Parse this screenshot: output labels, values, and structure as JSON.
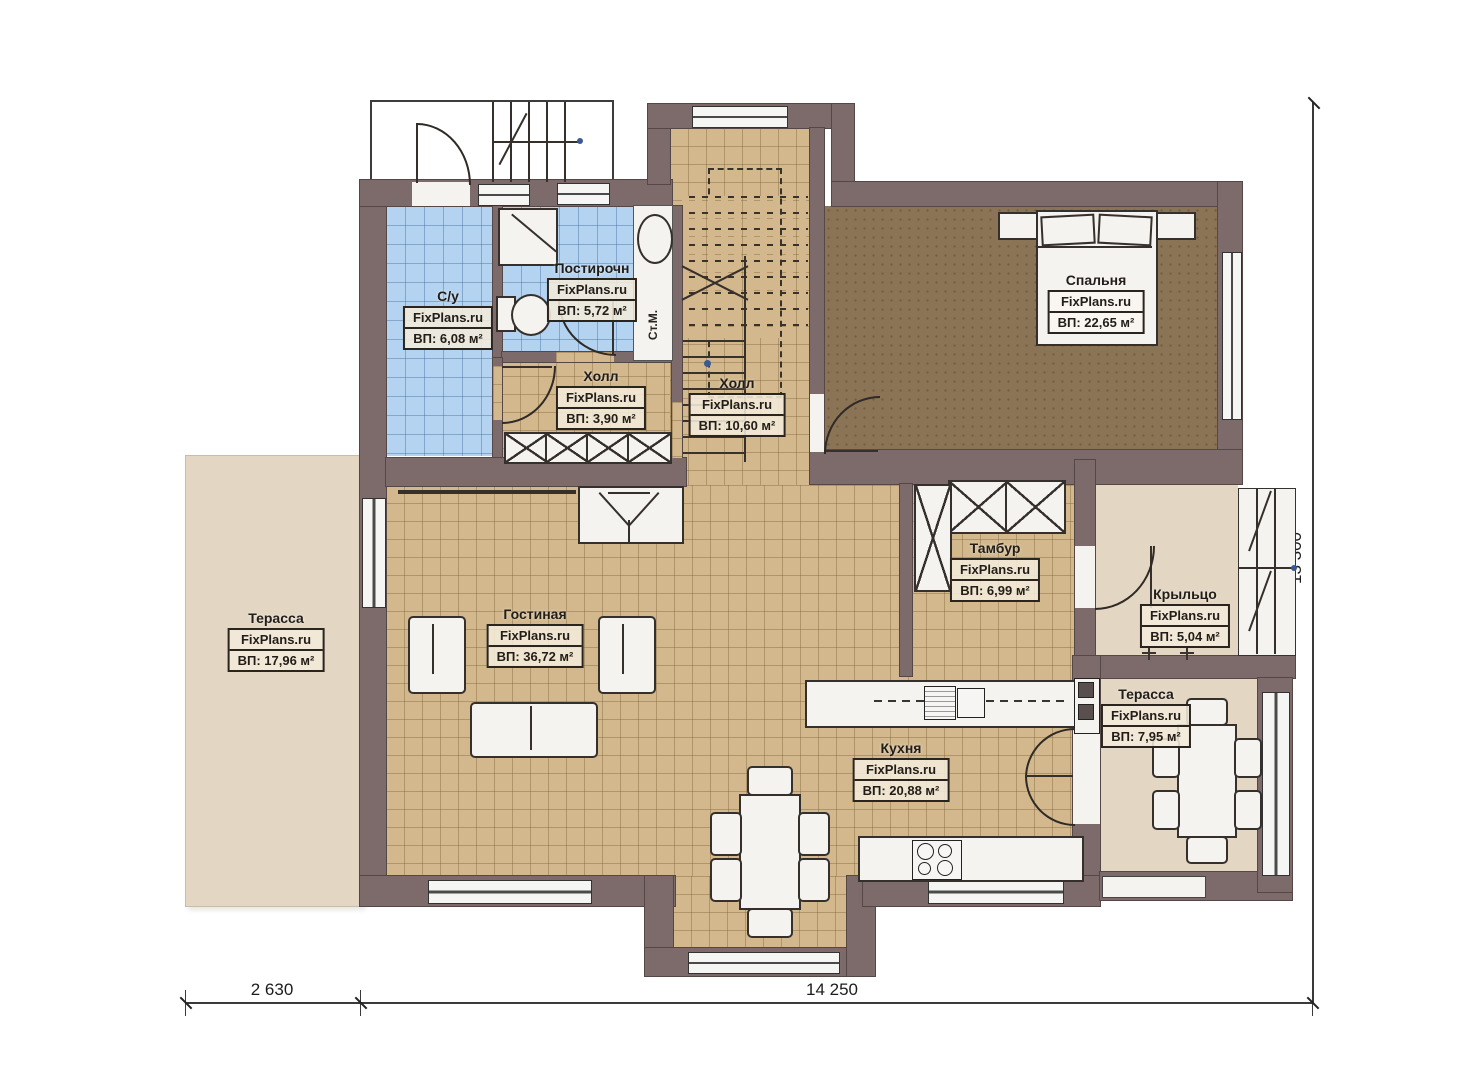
{
  "watermark": "FixPlans.ru",
  "rooms": [
    {
      "key": "su",
      "name": "С/у",
      "area": "ВП: 6,08 м²"
    },
    {
      "key": "laundry",
      "name": "Постирочн",
      "area": "ВП: 5,72 м²"
    },
    {
      "key": "hall_small",
      "name": "Холл",
      "area": "ВП: 3,90 м²"
    },
    {
      "key": "hall_stairs",
      "name": "Холл",
      "area": "ВП: 10,60 м²"
    },
    {
      "key": "bedroom",
      "name": "Спальня",
      "area": "ВП: 22,65 м²"
    },
    {
      "key": "tambour",
      "name": "Тамбур",
      "area": "ВП: 6,99 м²"
    },
    {
      "key": "porch",
      "name": "Крыльцо",
      "area": "ВП: 5,04 м²"
    },
    {
      "key": "terrace_left",
      "name": "Терасса",
      "area": "ВП: 17,96 м²"
    },
    {
      "key": "living",
      "name": "Гостиная",
      "area": "ВП: 36,72 м²"
    },
    {
      "key": "kitchen",
      "name": "Кухня",
      "area": "ВП: 20,88 м²"
    },
    {
      "key": "terrace_right",
      "name": "Терасса",
      "area": "ВП: 7,95 м²"
    }
  ],
  "annotations": {
    "washing_machine": "Ст.М."
  },
  "dimensions": {
    "bottom_left": "2 630",
    "bottom_main": "14 250",
    "right_side": "13 300"
  },
  "colors": {
    "wall": "#7d6a6a",
    "tile_floor": "#d2b88c",
    "wet_floor": "#b4d3f0",
    "bedroom_floor": "#8b7455",
    "terrace_floor": "#e3d6c2",
    "fixture": "#f4f3f0",
    "line": "#2f2a26"
  }
}
